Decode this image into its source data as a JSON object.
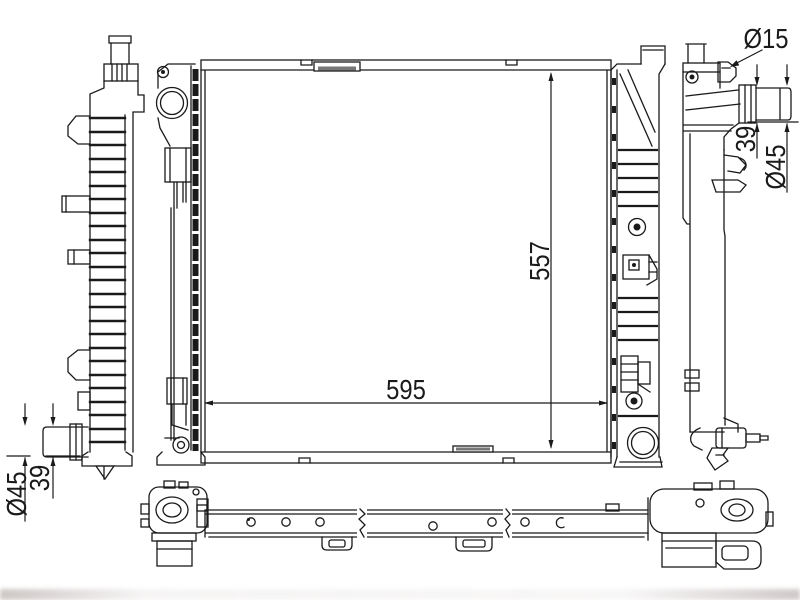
{
  "drawing": {
    "type": "technical-drawing",
    "subject": "automotive radiator multi-view schematic",
    "dimensions": {
      "fitting_diameter_label": "Ø15",
      "inlet_stub_length_label": "39",
      "inlet_diameter_label": "Ø45",
      "core_height_label": "557",
      "core_width_label": "595",
      "outlet_stub_length_label": "39",
      "outlet_diameter_label": "Ø45"
    },
    "colors": {
      "line": "#1a1a1a",
      "background": "#ffffff",
      "hatch": "#777777"
    }
  }
}
